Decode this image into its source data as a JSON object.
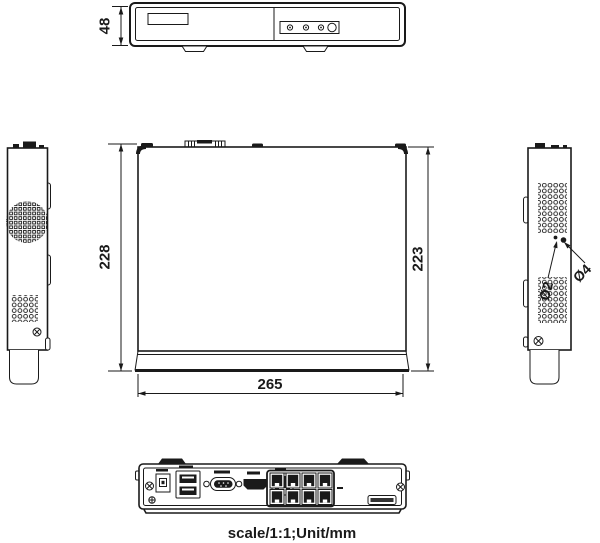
{
  "page": {
    "caption": "scale/1:1;Unit/mm",
    "background": "#ffffff",
    "line_color": "#1a1a1a"
  },
  "dimensions": {
    "front_height_mm": "48",
    "depth_total_mm": "228",
    "depth_body_mm": "223",
    "width_mm": "265",
    "vent_hole_small": "Ø2",
    "vent_hole_large": "Ø4"
  }
}
